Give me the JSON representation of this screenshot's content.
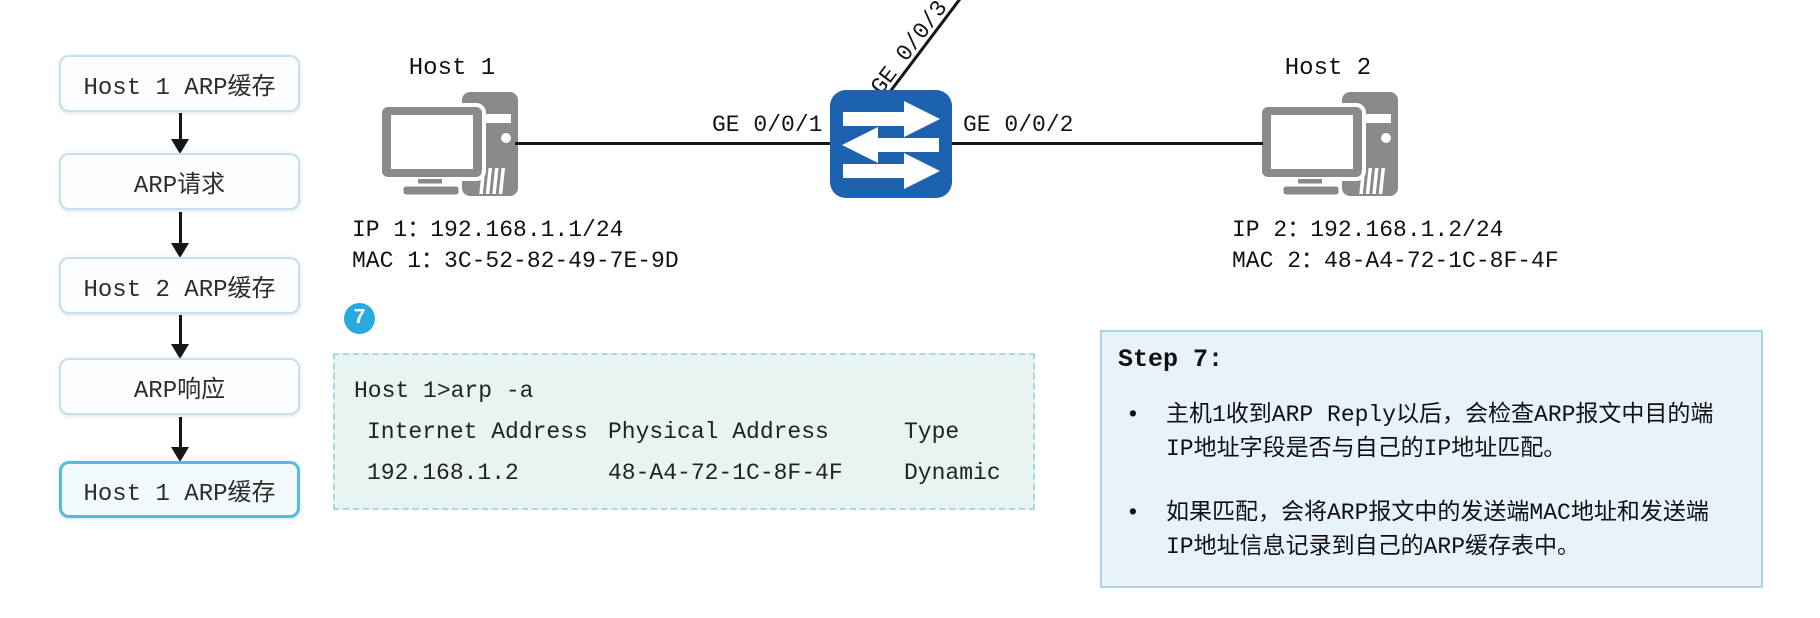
{
  "flowchart": {
    "steps": [
      {
        "label": "Host 1 ARP缓存",
        "highlighted": false
      },
      {
        "label": "ARP请求",
        "highlighted": false
      },
      {
        "label": "Host 2 ARP缓存",
        "highlighted": false
      },
      {
        "label": "ARP响应",
        "highlighted": false
      },
      {
        "label": "Host 1 ARP缓存",
        "highlighted": true
      }
    ]
  },
  "topology": {
    "host1": {
      "name": "Host 1",
      "ip": "IP 1：192.168.1.1/24",
      "mac": "MAC 1：3C-52-82-49-7E-9D"
    },
    "host2": {
      "name": "Host 2",
      "ip": "IP 2：192.168.1.2/24",
      "mac": "MAC 2：48-A4-72-1C-8F-4F"
    },
    "switch_ports": {
      "left": "GE 0/0/1",
      "right": "GE 0/0/2",
      "top": "GE 0/0/3"
    }
  },
  "badge": {
    "label": "7"
  },
  "terminal": {
    "command": "Host 1>arp -a",
    "columns": [
      "Internet Address",
      "Physical Address",
      "Type"
    ],
    "rows": [
      [
        "192.168.1.2",
        "48-A4-72-1C-8F-4F",
        "Dynamic"
      ]
    ]
  },
  "panel": {
    "title": "Step 7:",
    "bullet_glyph": "•",
    "bullets": [
      "主机1收到ARP Reply以后，会检查ARP报文中目的端IP地址字段是否与自己的IP地址匹配。",
      "如果匹配，会将ARP报文中的发送端MAC地址和发送端IP地址信息记录到自己的ARP缓存表中。"
    ]
  },
  "colors": {
    "switch-blue": "#1c62ae",
    "badge-blue": "#29a9e1",
    "flow-border": "#c9dfe9",
    "flow-hl-border": "#55bcd9",
    "term-border": "#a9d8e0",
    "term-bg": "#e8f4f1",
    "panel-border": "#abd2e8",
    "panel-bg": "#e7f2fa",
    "icon-gray": "#8a8a8a",
    "line-black": "#161616"
  }
}
